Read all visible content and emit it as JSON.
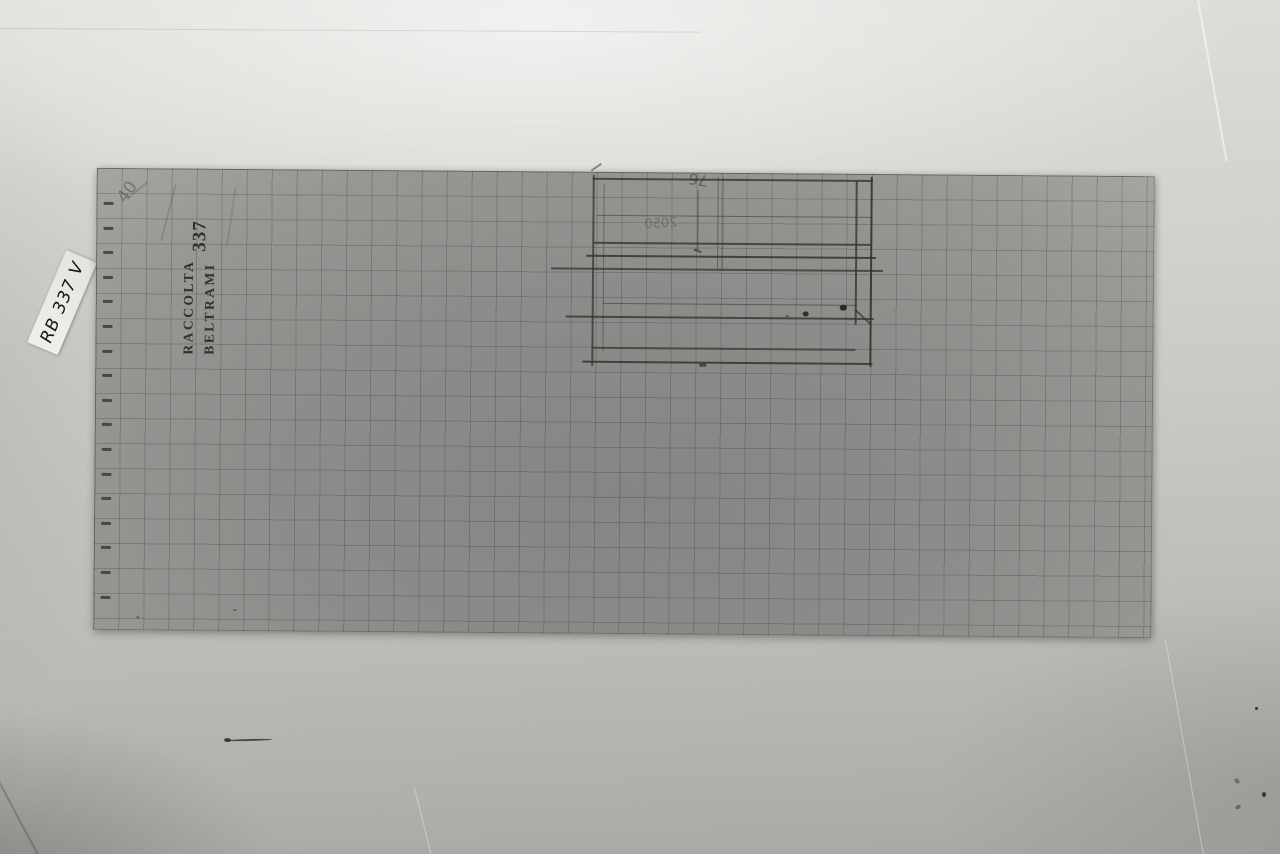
{
  "label_slip": {
    "text": "RB 337 V"
  },
  "stamp": {
    "line1": "RACCOLTA",
    "line2": "BELTRAMI",
    "number": "337"
  },
  "paper": {
    "grid_size_px": 25,
    "ticks": {
      "count": 17,
      "x": 7,
      "y0": 34,
      "step": 24.6
    }
  },
  "colors": {
    "backdrop": "#c9c9c5",
    "paper": "#8c8c8a",
    "grid_line": "#6f6f74",
    "pencil": "#34342f",
    "stamp_ink": "#232320",
    "slip": "#ecebe7"
  },
  "sketch": {
    "lines": [
      {
        "x": 496,
        "y": 3,
        "w": 2,
        "h": 191,
        "o": 0.75
      },
      {
        "x": 507,
        "y": 12,
        "w": 1,
        "h": 168,
        "o": 0.45
      },
      {
        "x": 759,
        "y": 7,
        "w": 2,
        "h": 144,
        "o": 0.8
      },
      {
        "x": 774,
        "y": 3,
        "w": 2,
        "h": 190,
        "o": 0.9
      },
      {
        "x": 601,
        "y": 18,
        "w": 1,
        "h": 60,
        "o": 0.6
      },
      {
        "x": 621,
        "y": 4,
        "w": 1,
        "h": 92,
        "o": 0.5
      },
      {
        "x": 626,
        "y": 4,
        "w": 1,
        "h": 92,
        "o": 0.4
      },
      {
        "x": 496,
        "y": 6,
        "w": 280,
        "h": 2,
        "o": 0.8
      },
      {
        "x": 500,
        "y": 43,
        "w": 274,
        "h": 1,
        "o": 0.55
      },
      {
        "x": 497,
        "y": 70,
        "w": 278,
        "h": 2,
        "o": 0.8
      },
      {
        "x": 490,
        "y": 83,
        "w": 290,
        "h": 2,
        "o": 0.85
      },
      {
        "x": 455,
        "y": 96,
        "w": 332,
        "h": 2,
        "o": 0.75
      },
      {
        "x": 507,
        "y": 131,
        "w": 255,
        "h": 1,
        "o": 0.55
      },
      {
        "x": 470,
        "y": 144,
        "w": 308,
        "h": 2,
        "o": 0.8
      },
      {
        "x": 496,
        "y": 175,
        "w": 264,
        "h": 1.5,
        "o": 0.7
      },
      {
        "x": 487,
        "y": 189,
        "w": 290,
        "h": 2,
        "o": 0.85
      },
      {
        "x": 760,
        "y": 135,
        "w": 22,
        "h": 1.5,
        "o": 0.7,
        "r": 43
      },
      {
        "x": 494,
        "y": -2,
        "w": 12,
        "h": 1.5,
        "o": 0.5,
        "r": -35
      },
      {
        "x": 598,
        "y": 76,
        "w": 8,
        "h": 2,
        "o": 0.7,
        "r": 20
      },
      {
        "x": 604,
        "y": 191,
        "w": 7,
        "h": 2.5,
        "o": 0.8
      },
      {
        "x": 78,
        "y": 16,
        "w": 1.5,
        "h": 58,
        "o": 0.18,
        "r": 14
      },
      {
        "x": 138,
        "y": 18,
        "w": 1.5,
        "h": 60,
        "o": 0.15,
        "r": 8
      },
      {
        "x": 30,
        "y": 30,
        "w": 26,
        "h": 2,
        "o": 0.2,
        "r": -40
      }
    ],
    "dots": [
      {
        "x": 707,
        "y": 138,
        "s": 6,
        "o": 0.9
      },
      {
        "x": 744,
        "y": 131,
        "s": 7,
        "o": 0.95
      },
      {
        "x": 690,
        "y": 142,
        "s": 3,
        "o": 0.6
      },
      {
        "x": 43,
        "y": 448,
        "s": 3,
        "o": 0.5
      },
      {
        "x": 140,
        "y": 440,
        "s": 3,
        "o": 0.5
      }
    ],
    "faint_texts": [
      {
        "text": "76",
        "x": 592,
        "y": -2,
        "size": 15,
        "o": 0.5,
        "t": "rotate(188deg)"
      },
      {
        "text": "2050",
        "x": 548,
        "y": 44,
        "size": 13,
        "o": 0.32,
        "t": "scaleX(-1) rotate(4deg)"
      },
      {
        "text": "40",
        "x": 20,
        "y": 14,
        "size": 17,
        "o": 0.38,
        "t": "rotate(-55deg)"
      }
    ]
  },
  "backdrop": {
    "creases": [
      {
        "x": 0,
        "y": 28,
        "w": 700,
        "h": 1,
        "o": 0.1,
        "light": false,
        "r": 0.3
      },
      {
        "x": 1196,
        "y": -6,
        "w": 1.5,
        "h": 170,
        "o": 0.5,
        "light": true,
        "r": -10
      },
      {
        "x": -4,
        "y": 778,
        "w": 1.5,
        "h": 110,
        "o": 0.2,
        "light": false,
        "r": -28
      },
      {
        "x": 414,
        "y": 788,
        "w": 1,
        "h": 80,
        "o": 0.35,
        "light": true,
        "r": -14
      },
      {
        "x": 1165,
        "y": 640,
        "w": 1,
        "h": 230,
        "o": 0.35,
        "light": true,
        "r": -10
      }
    ],
    "specks": [
      {
        "x": 1255,
        "y": 707,
        "w": 3,
        "h": 3,
        "o": 0.85
      },
      {
        "x": 1234,
        "y": 779,
        "w": 6,
        "h": 4,
        "o": 0.4,
        "r": 40
      },
      {
        "x": 1262,
        "y": 792,
        "w": 4,
        "h": 5,
        "o": 0.8
      },
      {
        "x": 1235,
        "y": 805,
        "w": 6,
        "h": 4,
        "o": 0.4,
        "r": -30
      },
      {
        "x": 226,
        "y": 739,
        "w": 46,
        "h": 2,
        "o": 0.7,
        "r": -1.5
      },
      {
        "x": 224,
        "y": 738,
        "w": 7,
        "h": 4,
        "o": 0.75
      }
    ]
  }
}
